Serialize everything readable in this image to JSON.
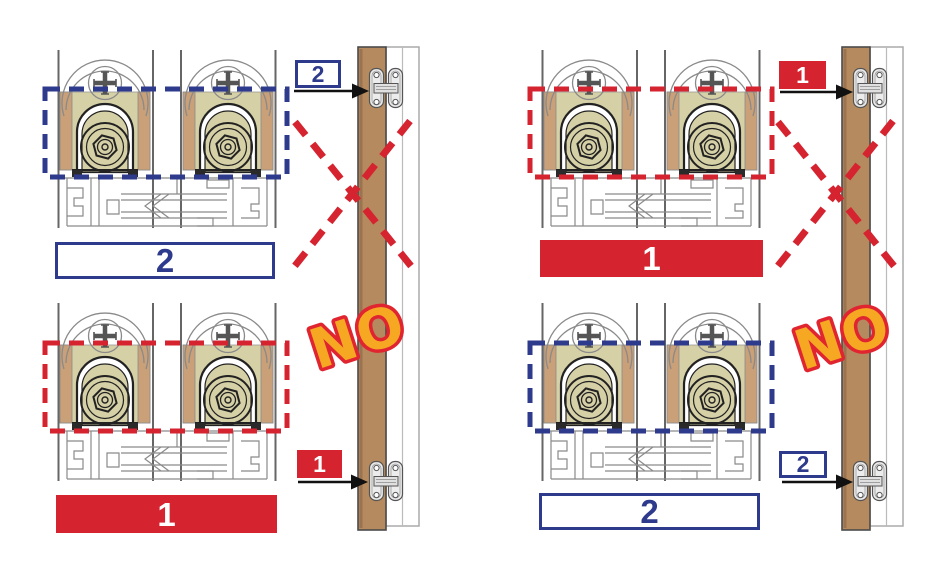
{
  "image": {
    "width": 947,
    "height": 581,
    "background": "#ffffff"
  },
  "colors": {
    "blue": "#2e3a8c",
    "red": "#d5232f",
    "orange": "#f6a823",
    "outline": "#e02531",
    "wood": "#b58a5e",
    "woodlight": "#c9a078",
    "khaki": "#d6d0a6"
  },
  "panels": [
    {
      "side": "left",
      "no_label": "NO",
      "assemblies": [
        {
          "position": "top",
          "label": "2",
          "style": "blue-outline",
          "highlight": "blue-dashed"
        },
        {
          "position": "bottom",
          "label": "1",
          "style": "red-filled",
          "highlight": "red-dashed"
        }
      ],
      "hinge_callouts": [
        {
          "position": "top",
          "label": "2",
          "style": "blue-outline"
        },
        {
          "position": "bottom",
          "label": "1",
          "style": "red-filled"
        }
      ]
    },
    {
      "side": "right",
      "no_label": "NO",
      "assemblies": [
        {
          "position": "top",
          "label": "1",
          "style": "red-filled",
          "highlight": "red-dashed"
        },
        {
          "position": "bottom",
          "label": "2",
          "style": "blue-outline",
          "highlight": "blue-dashed"
        }
      ],
      "hinge_callouts": [
        {
          "position": "top",
          "label": "1",
          "style": "red-filled"
        },
        {
          "position": "bottom",
          "label": "2",
          "style": "blue-outline"
        }
      ]
    }
  ]
}
